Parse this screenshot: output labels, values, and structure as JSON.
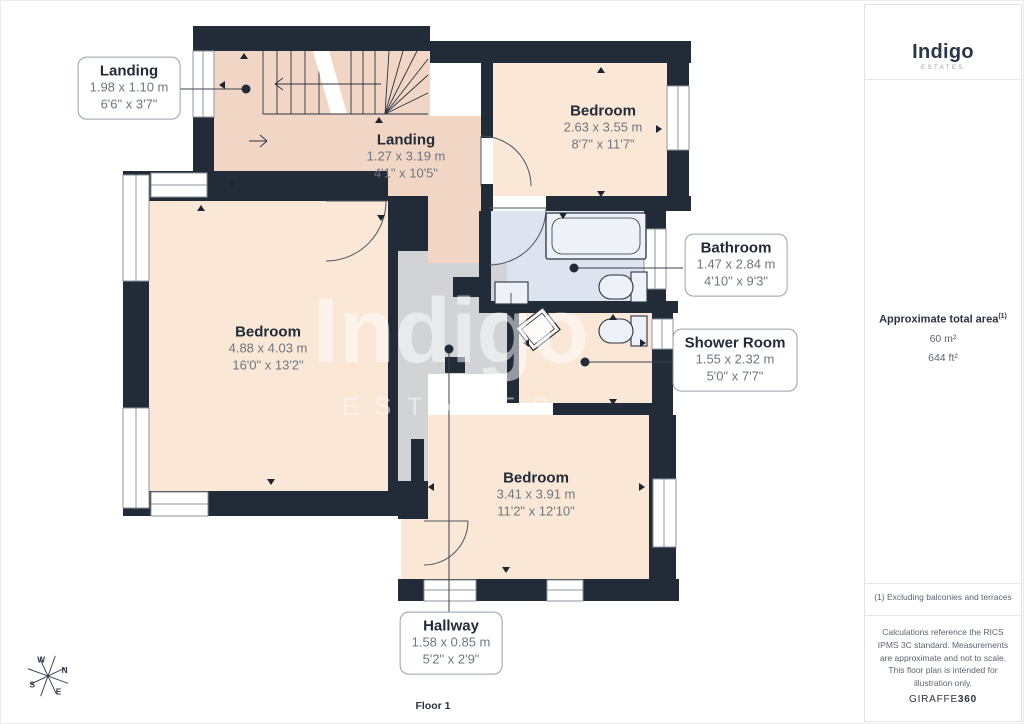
{
  "brand": {
    "logo": "Indigo",
    "logo_sub": "ESTATES"
  },
  "watermark": {
    "text": "Indigo",
    "sub": "ESTATES"
  },
  "floor": {
    "label": "Floor 1"
  },
  "rooms": {
    "landing_small": {
      "name": "Landing",
      "metric": "1.98 x 1.10 m",
      "imperial": "6'6\" x 3'7\""
    },
    "landing_main": {
      "name": "Landing",
      "metric": "1.27 x 3.19 m",
      "imperial": "4'1\" x 10'5\""
    },
    "bedroom_top": {
      "name": "Bedroom",
      "metric": "2.63 x 3.55 m",
      "imperial": "8'7\" x 11'7\""
    },
    "bedroom_left": {
      "name": "Bedroom",
      "metric": "4.88 x 4.03 m",
      "imperial": "16'0\" x 13'2\""
    },
    "bathroom": {
      "name": "Bathroom",
      "metric": "1.47 x 2.84 m",
      "imperial": "4'10\" x 9'3\""
    },
    "shower_room": {
      "name": "Shower Room",
      "metric": "1.55 x 2.32 m",
      "imperial": "5'0\" x 7'7\""
    },
    "bedroom_bottom": {
      "name": "Bedroom",
      "metric": "3.41 x 3.91 m",
      "imperial": "11'2\" x 12'10\""
    },
    "hallway": {
      "name": "Hallway",
      "metric": "1.58 x 0.85 m",
      "imperial": "5'2\" x 2'9\""
    }
  },
  "sidebar": {
    "area_title": "Approximate total area",
    "area_superscript": "(1)",
    "area_m2": "60 m²",
    "area_ft2": "644 ft²",
    "footnote": "(1) Excluding balconies and terraces",
    "disclaimer": "Calculations reference the RICS IPMS 3C standard. Measurements are approximate and not to scale. This floor plan is intended for illustration only.",
    "provider": "GIRAFFE",
    "provider_suffix": "360"
  },
  "compass": {
    "n": "N",
    "s": "S",
    "e": "E",
    "w": "W"
  },
  "colors": {
    "wall": "#222c39",
    "room_fill": "#fbe7d6",
    "landing_fill": "#f2d6c5",
    "bathroom_tile": "#dde3ef",
    "secondary_gray": "#d2d3d5",
    "accent_navy": "#2a3342"
  }
}
